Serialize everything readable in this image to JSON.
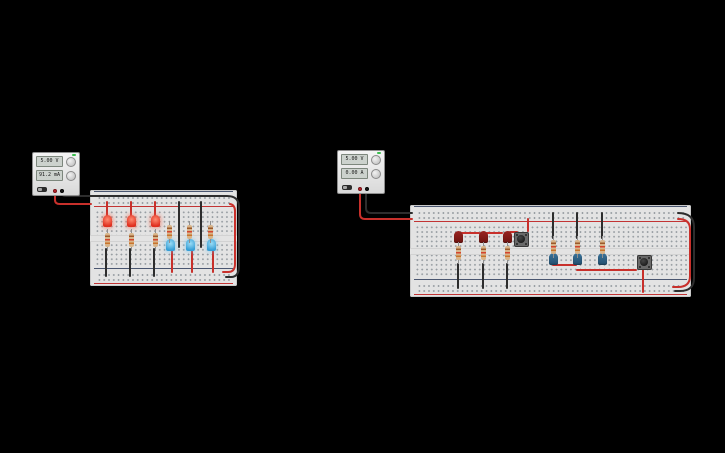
{
  "power_supplies": {
    "left": {
      "voltage": "5.00 V",
      "current": "91.2 mA"
    },
    "right": {
      "voltage": "5.00 V",
      "current": "0.00 A"
    }
  },
  "colors": {
    "wire_red": "#c8302b",
    "wire_black": "#2d2d2d",
    "led_red_on": "#e23a28",
    "led_red_off": "#7c1a16",
    "led_blue_on": "#4db4e8",
    "led_blue_off": "#2d6b8f",
    "breadboard": "#e3e3e3",
    "rail_positive_line": "#c23434",
    "rail_negative_line": "#4a5670"
  },
  "components": {
    "leds": [
      {
        "pos": [
          107,
          221
        ],
        "variant": "red-on"
      },
      {
        "pos": [
          131,
          221
        ],
        "variant": "red-on"
      },
      {
        "pos": [
          155,
          221
        ],
        "variant": "red-on"
      },
      {
        "pos": [
          170,
          245
        ],
        "variant": "blue-on"
      },
      {
        "pos": [
          190,
          245
        ],
        "variant": "blue-on"
      },
      {
        "pos": [
          211,
          245
        ],
        "variant": "blue-on"
      },
      {
        "pos": [
          458,
          237
        ],
        "variant": "red-off"
      },
      {
        "pos": [
          483,
          237
        ],
        "variant": "red-off"
      },
      {
        "pos": [
          507,
          237
        ],
        "variant": "red-off"
      },
      {
        "pos": [
          553,
          259
        ],
        "variant": "blue-off"
      },
      {
        "pos": [
          577,
          259
        ],
        "variant": "blue-off"
      },
      {
        "pos": [
          602,
          259
        ],
        "variant": "blue-off"
      }
    ],
    "resistors": [
      {
        "pos": [
          107,
          240
        ]
      },
      {
        "pos": [
          131,
          240
        ]
      },
      {
        "pos": [
          155,
          240
        ]
      },
      {
        "pos": [
          169,
          232
        ]
      },
      {
        "pos": [
          189,
          232
        ]
      },
      {
        "pos": [
          210,
          232
        ]
      },
      {
        "pos": [
          458,
          253
        ]
      },
      {
        "pos": [
          483,
          253
        ]
      },
      {
        "pos": [
          507,
          253
        ]
      },
      {
        "pos": [
          553,
          247
        ]
      },
      {
        "pos": [
          577,
          247
        ]
      },
      {
        "pos": [
          602,
          247
        ]
      }
    ],
    "pushbuttons": [
      {
        "pos": [
          521,
          239
        ]
      },
      {
        "pos": [
          644,
          262
        ]
      }
    ],
    "wires": [
      {
        "name": "supply1-positive-wire",
        "color": "wire_red",
        "path": "M55,187 V200 Q55,204 60,204 H91"
      },
      {
        "name": "supply1-negative-wire",
        "color": "wire_black",
        "path": "M61,187 V191 Q61,196 66,196 H227 Q239,196 239,207 V266 Q239,277 231,277 H226"
      },
      {
        "name": "rail-link-red-left",
        "color": "wire_red",
        "path": "M230,204 Q235,205 235,211 V264 Q235,272 228,272 H223"
      },
      {
        "name": "jumper-red",
        "color": "wire_red",
        "path": "M107,202 V216"
      },
      {
        "name": "jumper-red",
        "color": "wire_red",
        "path": "M131,202 V216"
      },
      {
        "name": "jumper-red",
        "color": "wire_red",
        "path": "M155,202 V216"
      },
      {
        "name": "jumper-black",
        "color": "wire_black",
        "path": "M179,202 V247"
      },
      {
        "name": "jumper-black",
        "color": "wire_black",
        "path": "M201,202 V247"
      },
      {
        "name": "jumper-black",
        "color": "wire_black",
        "path": "M106,249 V276"
      },
      {
        "name": "jumper-black",
        "color": "wire_black",
        "path": "M130,249 V276"
      },
      {
        "name": "jumper-black",
        "color": "wire_black",
        "path": "M154,249 V276"
      },
      {
        "name": "jumper-red",
        "color": "wire_red",
        "path": "M172,251 V272"
      },
      {
        "name": "jumper-red",
        "color": "wire_red",
        "path": "M192,251 V272"
      },
      {
        "name": "jumper-red",
        "color": "wire_red",
        "path": "M213,251 V272"
      },
      {
        "name": "supply2-positive-wire",
        "color": "wire_red",
        "path": "M360,187 V214 Q360,219 365,219 H412"
      },
      {
        "name": "supply2-negative-wire",
        "color": "wire_black",
        "path": "M366,187 V208 Q366,213 371,213 H412"
      },
      {
        "name": "rail-link-black-right",
        "color": "wire_black",
        "path": "M678,213 Q694,213 694,227 V278 Q694,291 680,291 H675"
      },
      {
        "name": "rail-link-red-right",
        "color": "wire_red",
        "path": "M678,219 Q690,219 690,229 V276 Q690,287 678,287 H673"
      },
      {
        "name": "jumper-red",
        "color": "wire_red",
        "path": "M528,219 V231"
      },
      {
        "name": "jumper-red",
        "color": "wire_red",
        "path": "M462,233 H479"
      },
      {
        "name": "jumper-red",
        "color": "wire_red",
        "path": "M487,233 H502"
      },
      {
        "name": "jumper-red",
        "color": "wire_red",
        "path": "M510,232 H517"
      },
      {
        "name": "jumper-red",
        "color": "wire_red",
        "path": "M553,265 H576"
      },
      {
        "name": "jumper-red",
        "color": "wire_red",
        "path": "M577,270 H636"
      },
      {
        "name": "jumper-red",
        "color": "wire_red",
        "path": "M643,270 V292"
      },
      {
        "name": "jumper-black",
        "color": "wire_black",
        "path": "M553,213 V238"
      },
      {
        "name": "jumper-black",
        "color": "wire_black",
        "path": "M577,213 V238"
      },
      {
        "name": "jumper-black",
        "color": "wire_black",
        "path": "M602,213 V238"
      },
      {
        "name": "jumper-black",
        "color": "wire_black",
        "path": "M458,264 V288"
      },
      {
        "name": "jumper-black",
        "color": "wire_black",
        "path": "M483,264 V288"
      },
      {
        "name": "jumper-black",
        "color": "wire_black",
        "path": "M507,264 V288"
      }
    ]
  }
}
